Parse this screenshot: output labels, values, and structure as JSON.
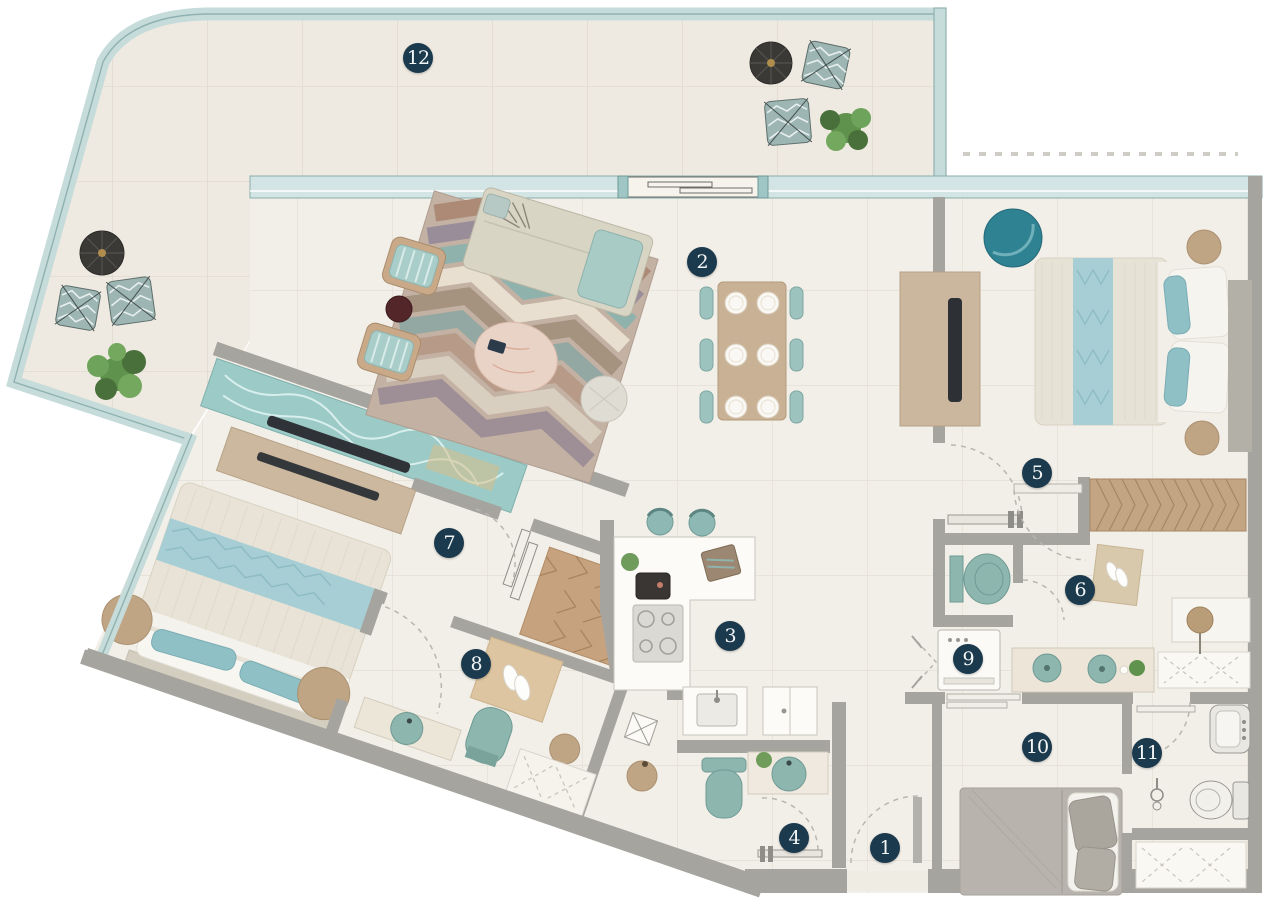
{
  "canvas": {
    "width": 1265,
    "height": 900
  },
  "markers": [
    {
      "label": "1",
      "x": 885,
      "y": 848
    },
    {
      "label": "2",
      "x": 702,
      "y": 262
    },
    {
      "label": "3",
      "x": 730,
      "y": 636
    },
    {
      "label": "4",
      "x": 794,
      "y": 838
    },
    {
      "label": "5",
      "x": 1037,
      "y": 473
    },
    {
      "label": "6",
      "x": 1080,
      "y": 590
    },
    {
      "label": "7",
      "x": 449,
      "y": 543
    },
    {
      "label": "8",
      "x": 476,
      "y": 664
    },
    {
      "label": "9",
      "x": 968,
      "y": 659
    },
    {
      "label": "10",
      "x": 1037,
      "y": 747
    },
    {
      "label": "11",
      "x": 1147,
      "y": 753
    },
    {
      "label": "12",
      "x": 418,
      "y": 58
    }
  ],
  "colors": {
    "marker_bg": "#1c3a4e",
    "marker_text": "#f4f6f6",
    "glass": "#c6dcda",
    "glass_edge": "#8fb1af",
    "wall": "#a6a49f",
    "wall_dark": "#8f8d88",
    "floor": "#f2efe8",
    "floor_line": "#e3ded4",
    "terrace_floor": "#efeae1",
    "wood": "#c9b195",
    "water": "#9ccac6",
    "teal_fixture": "#8db6ae",
    "teal_deep": "#2f8292",
    "bed_stripe": "#a6ced4",
    "tan": "#c0a585"
  }
}
